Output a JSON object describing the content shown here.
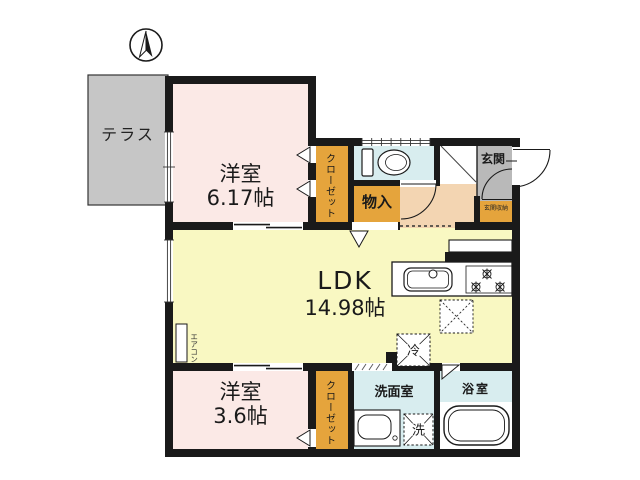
{
  "plan_title": "2LDK floor plan",
  "colors": {
    "wall": "#1a1a1a",
    "room_pink": "#fbe9e6",
    "ldk_yellow": "#f9f8c2",
    "closet_orange": "#e5a43c",
    "wet_blue": "#d8edef",
    "hall_peach": "#f3d5b2",
    "entrance_gray": "#b9b9b9",
    "terrace_gray": "#c6c6c6"
  },
  "labels": {
    "terrace": "テラス",
    "bedroom1_name": "洋室",
    "bedroom1_size": "6.17帖",
    "closet_top": "クローゼット",
    "storage": "物入",
    "entrance": "玄関",
    "entrance_storage": "玄関収納",
    "ldk_name": "LDK",
    "ldk_size": "14.98帖",
    "aircon": "エアコン",
    "bedroom2_name": "洋室",
    "bedroom2_size": "3.6帖",
    "closet_bottom": "クローゼット",
    "washroom": "洗面室",
    "washer": "洗",
    "fridge": "冷",
    "bathroom": "浴室"
  }
}
